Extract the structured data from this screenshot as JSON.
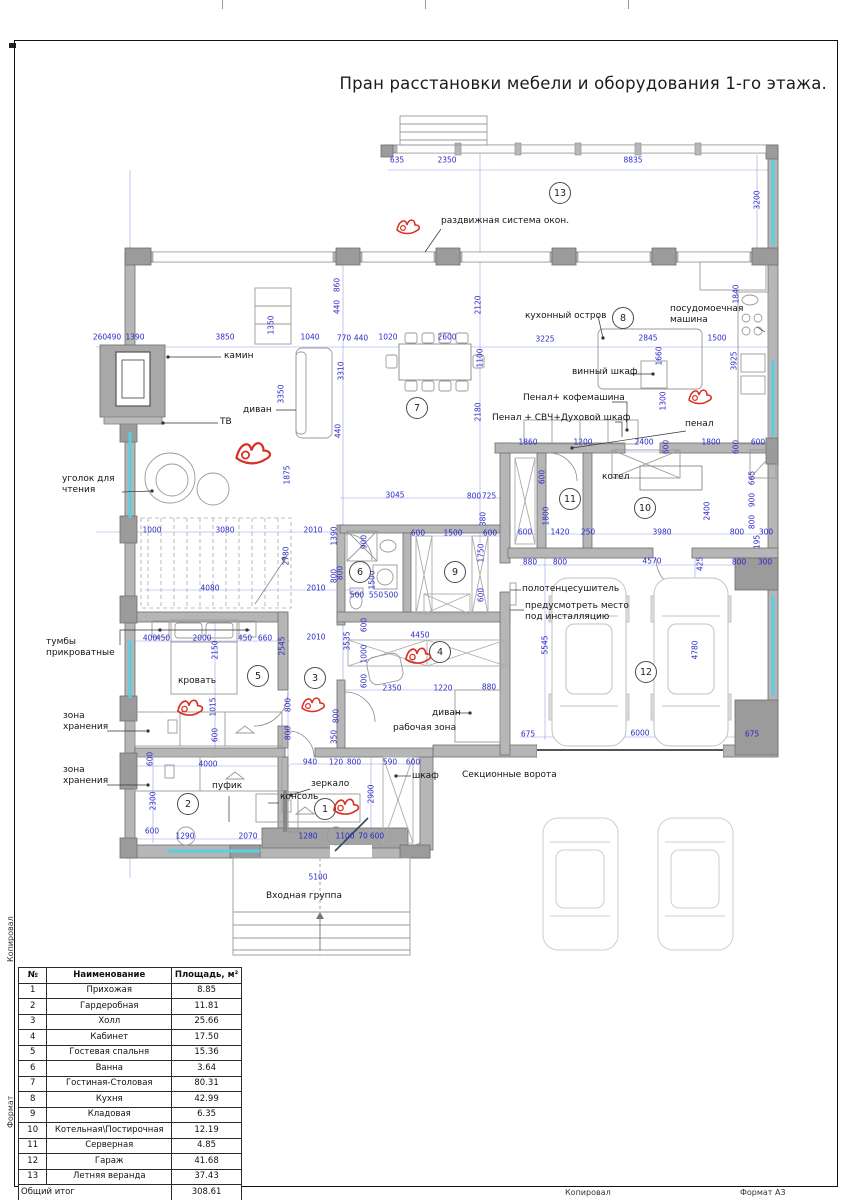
{
  "sheet": {
    "title": "Пран расстановки мебели и оборудования 1-го этажа.",
    "footer": {
      "copied_by": "Копировал",
      "format": "Формат А3"
    },
    "side": {
      "upper": "Копировал",
      "lower": "Формат"
    }
  },
  "table": {
    "headers": [
      "№",
      "Наименование",
      "Площадь, м²"
    ],
    "rows": [
      [
        "1",
        "Прихожая",
        "8.85"
      ],
      [
        "2",
        "Гардеробная",
        "11.81"
      ],
      [
        "3",
        "Холл",
        "25.66"
      ],
      [
        "4",
        "Кабинет",
        "17.50"
      ],
      [
        "5",
        "Гостевая спальня",
        "15.36"
      ],
      [
        "6",
        "Ванна",
        "3.64"
      ],
      [
        "7",
        "Гостиная-Столовая",
        "80.31"
      ],
      [
        "8",
        "Кухня",
        "42.99"
      ],
      [
        "9",
        "Кладовая",
        "6.35"
      ],
      [
        "10",
        "Котельная\\Постирочная",
        "12.19"
      ],
      [
        "11",
        "Серверная",
        "4.85"
      ],
      [
        "12",
        "Гараж",
        "41.68"
      ],
      [
        "13",
        "Летняя веранда",
        "37.43"
      ]
    ],
    "total_label": "Общий итог",
    "total_value": "308.61"
  },
  "plan": {
    "colors": {
      "dim": "#2a2ac8",
      "wall": "#b6b6b6",
      "window": "#58cfe4",
      "mark": "#d93025"
    },
    "rooms": [
      {
        "n": "1",
        "x": 325,
        "y": 809
      },
      {
        "n": "2",
        "x": 188,
        "y": 804
      },
      {
        "n": "3",
        "x": 315,
        "y": 678
      },
      {
        "n": "4",
        "x": 440,
        "y": 652
      },
      {
        "n": "5",
        "x": 258,
        "y": 676
      },
      {
        "n": "6",
        "x": 360,
        "y": 572
      },
      {
        "n": "7",
        "x": 417,
        "y": 408
      },
      {
        "n": "8",
        "x": 623,
        "y": 318
      },
      {
        "n": "9",
        "x": 455,
        "y": 572
      },
      {
        "n": "10",
        "x": 645,
        "y": 508
      },
      {
        "n": "11",
        "x": 570,
        "y": 499
      },
      {
        "n": "12",
        "x": 646,
        "y": 672
      },
      {
        "n": "13",
        "x": 560,
        "y": 193
      }
    ],
    "labels": [
      {
        "t": "раздвижная система окон.",
        "x": 441,
        "y": 216
      },
      {
        "t": "камин",
        "x": 224,
        "y": 351
      },
      {
        "t": "ТВ",
        "x": 220,
        "y": 417
      },
      {
        "t": "диван",
        "x": 243,
        "y": 405
      },
      {
        "t": "уголок для\nчтения",
        "x": 62,
        "y": 474
      },
      {
        "t": "кухонный остров",
        "x": 525,
        "y": 311
      },
      {
        "t": "посудомоечная\nмашина",
        "x": 670,
        "y": 304
      },
      {
        "t": "винный шкаф",
        "x": 572,
        "y": 367
      },
      {
        "t": "Пенал+ кофемашина",
        "x": 523,
        "y": 393
      },
      {
        "t": "Пенал + СВЧ+Духовой шкаф",
        "x": 492,
        "y": 413
      },
      {
        "t": "пенал",
        "x": 685,
        "y": 419
      },
      {
        "t": "котел",
        "x": 602,
        "y": 472
      },
      {
        "t": "полотенцесушитель",
        "x": 522,
        "y": 584
      },
      {
        "t": "предусмотреть место\nпод инсталляцию",
        "x": 525,
        "y": 601
      },
      {
        "t": "тумбы\nприкроватные",
        "x": 46,
        "y": 637
      },
      {
        "t": "кровать",
        "x": 178,
        "y": 676
      },
      {
        "t": "зона\nхранения",
        "x": 63,
        "y": 711
      },
      {
        "t": "зона\nхранения",
        "x": 63,
        "y": 765
      },
      {
        "t": "пуфик",
        "x": 212,
        "y": 781
      },
      {
        "t": "зеркало",
        "x": 311,
        "y": 779
      },
      {
        "t": "консоль",
        "x": 280,
        "y": 792
      },
      {
        "t": "шкаф",
        "x": 412,
        "y": 771
      },
      {
        "t": "рабочая зона",
        "x": 393,
        "y": 723
      },
      {
        "t": "диван",
        "x": 432,
        "y": 708
      },
      {
        "t": "Секционные ворота",
        "x": 462,
        "y": 770
      },
      {
        "t": "Входная группа",
        "x": 266,
        "y": 891
      }
    ],
    "dims": [
      [
        "635",
        397,
        160,
        0
      ],
      [
        "2350",
        447,
        160,
        0
      ],
      [
        "8835",
        633,
        160,
        0
      ],
      [
        "3200",
        757,
        200,
        1
      ],
      [
        "260",
        100,
        337,
        0
      ],
      [
        "490",
        114,
        337,
        0
      ],
      [
        "1390",
        135,
        337,
        0
      ],
      [
        "3850",
        225,
        337,
        0
      ],
      [
        "1040",
        310,
        337,
        0
      ],
      [
        "770",
        344,
        338,
        0
      ],
      [
        "440",
        361,
        338,
        0
      ],
      [
        "1020",
        388,
        337,
        0
      ],
      [
        "2600",
        447,
        337,
        0
      ],
      [
        "3225",
        545,
        339,
        0
      ],
      [
        "2845",
        648,
        338,
        0
      ],
      [
        "1500",
        717,
        338,
        0
      ],
      [
        "1840",
        736,
        294,
        1
      ],
      [
        "3925",
        734,
        361,
        1
      ],
      [
        "1660",
        659,
        356,
        1
      ],
      [
        "1350",
        271,
        325,
        1
      ],
      [
        "3350",
        281,
        394,
        1
      ],
      [
        "3310",
        341,
        371,
        1
      ],
      [
        "2120",
        478,
        305,
        1
      ],
      [
        "1100",
        480,
        358,
        1
      ],
      [
        "2180",
        478,
        412,
        1
      ],
      [
        "860",
        337,
        285,
        1
      ],
      [
        "440",
        337,
        307,
        1
      ],
      [
        "440",
        338,
        431,
        1
      ],
      [
        "1300",
        663,
        401,
        1
      ],
      [
        "1860",
        528,
        442,
        0
      ],
      [
        "1200",
        583,
        442,
        0
      ],
      [
        "2400",
        644,
        442,
        0
      ],
      [
        "600",
        666,
        447,
        1
      ],
      [
        "1800",
        711,
        442,
        0
      ],
      [
        "600",
        736,
        447,
        1
      ],
      [
        "600",
        758,
        442,
        0
      ],
      [
        "3045",
        395,
        495,
        0
      ],
      [
        "800",
        474,
        496,
        0
      ],
      [
        "725",
        489,
        496,
        0
      ],
      [
        "380",
        483,
        519,
        1
      ],
      [
        "1000",
        152,
        530,
        0
      ],
      [
        "3080",
        225,
        530,
        0
      ],
      [
        "2010",
        313,
        530,
        0
      ],
      [
        "600",
        418,
        533,
        0
      ],
      [
        "1500",
        453,
        533,
        0
      ],
      [
        "600",
        490,
        533,
        0
      ],
      [
        "1750",
        481,
        553,
        1
      ],
      [
        "600",
        481,
        595,
        1
      ],
      [
        "600",
        525,
        532,
        0
      ],
      [
        "1420",
        560,
        532,
        0
      ],
      [
        "250",
        588,
        532,
        0
      ],
      [
        "3980",
        662,
        532,
        0
      ],
      [
        "800",
        737,
        532,
        0
      ],
      [
        "300",
        766,
        532,
        0
      ],
      [
        "600",
        542,
        477,
        1
      ],
      [
        "1800",
        546,
        516,
        1
      ],
      [
        "2400",
        707,
        511,
        1
      ],
      [
        "665",
        752,
        478,
        1
      ],
      [
        "900",
        752,
        500,
        1
      ],
      [
        "800",
        752,
        522,
        1
      ],
      [
        "195",
        757,
        542,
        1
      ],
      [
        "880",
        530,
        562,
        0
      ],
      [
        "800",
        560,
        562,
        0
      ],
      [
        "4570",
        652,
        561,
        0
      ],
      [
        "425",
        700,
        564,
        1
      ],
      [
        "800",
        739,
        562,
        0
      ],
      [
        "300",
        765,
        562,
        0
      ],
      [
        "900",
        364,
        542,
        1
      ],
      [
        "1500",
        372,
        580,
        1
      ],
      [
        "1390",
        334,
        536,
        1
      ],
      [
        "800",
        334,
        576,
        1
      ],
      [
        "500",
        357,
        595,
        0
      ],
      [
        "550",
        376,
        595,
        0
      ],
      [
        "500",
        391,
        595,
        0
      ],
      [
        "1875",
        287,
        475,
        1
      ],
      [
        "4080",
        210,
        588,
        0
      ],
      [
        "2010",
        316,
        588,
        0
      ],
      [
        "2780",
        286,
        556,
        1
      ],
      [
        "800",
        340,
        573,
        1
      ],
      [
        "3535",
        347,
        641,
        1
      ],
      [
        "2545",
        282,
        646,
        1
      ],
      [
        "2010",
        316,
        637,
        0
      ],
      [
        "600",
        364,
        625,
        1
      ],
      [
        "4450",
        420,
        635,
        0
      ],
      [
        "1000",
        364,
        654,
        1
      ],
      [
        "600",
        364,
        681,
        1
      ],
      [
        "2350",
        392,
        688,
        0
      ],
      [
        "1220",
        443,
        688,
        0
      ],
      [
        "880",
        489,
        687,
        0
      ],
      [
        "800",
        336,
        716,
        1
      ],
      [
        "350",
        334,
        737,
        1
      ],
      [
        "400",
        150,
        638,
        0
      ],
      [
        "450",
        163,
        638,
        0
      ],
      [
        "2000",
        202,
        638,
        0
      ],
      [
        "450",
        245,
        638,
        0
      ],
      [
        "660",
        265,
        638,
        0
      ],
      [
        "2150",
        215,
        650,
        1
      ],
      [
        "1015",
        213,
        707,
        1
      ],
      [
        "600",
        215,
        735,
        1
      ],
      [
        "800",
        288,
        705,
        1
      ],
      [
        "800",
        288,
        733,
        1
      ],
      [
        "4000",
        208,
        764,
        0
      ],
      [
        "600",
        150,
        759,
        1
      ],
      [
        "940",
        310,
        762,
        0
      ],
      [
        "120",
        336,
        762,
        0
      ],
      [
        "800",
        354,
        762,
        0
      ],
      [
        "590",
        390,
        762,
        0
      ],
      [
        "600",
        413,
        762,
        0
      ],
      [
        "5545",
        545,
        645,
        1
      ],
      [
        "4780",
        695,
        650,
        1
      ],
      [
        "675",
        528,
        734,
        0
      ],
      [
        "6000",
        640,
        733,
        0
      ],
      [
        "675",
        752,
        734,
        0
      ],
      [
        "2300",
        153,
        801,
        1
      ],
      [
        "600",
        152,
        831,
        0
      ],
      [
        "1290",
        185,
        836,
        0
      ],
      [
        "2070",
        248,
        836,
        0
      ],
      [
        "1280",
        308,
        836,
        0
      ],
      [
        "1100",
        345,
        836,
        0
      ],
      [
        "70",
        363,
        836,
        0
      ],
      [
        "600",
        377,
        836,
        0
      ],
      [
        "2900",
        371,
        794,
        1
      ],
      [
        "5100",
        318,
        877,
        0
      ]
    ],
    "red_marks": [
      {
        "x": 408,
        "y": 228,
        "s": 1
      },
      {
        "x": 253,
        "y": 455,
        "s": 1.5
      },
      {
        "x": 700,
        "y": 398,
        "s": 1
      },
      {
        "x": 418,
        "y": 657,
        "s": 1.1
      },
      {
        "x": 190,
        "y": 709,
        "s": 1.1
      },
      {
        "x": 313,
        "y": 706,
        "s": 1
      },
      {
        "x": 346,
        "y": 808,
        "s": 1.1
      }
    ]
  }
}
